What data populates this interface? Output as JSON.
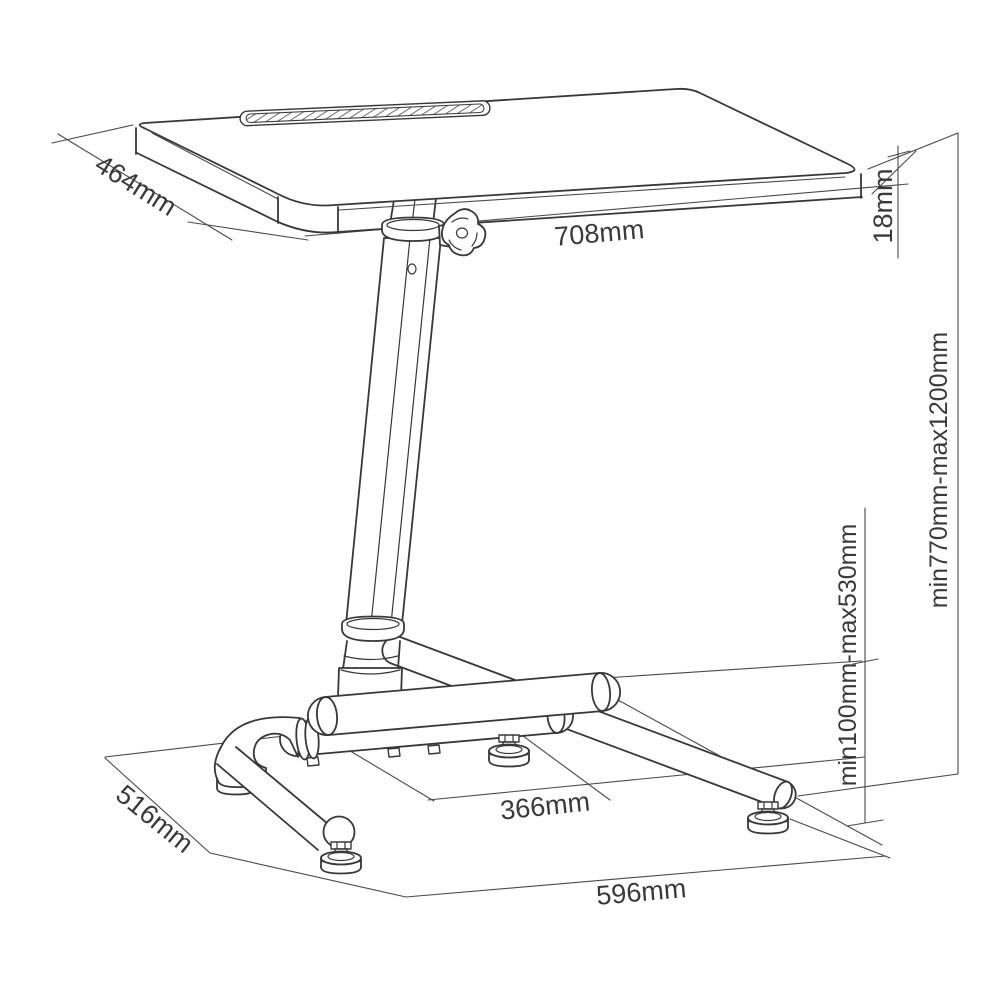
{
  "diagram": {
    "background": "#ffffff",
    "line_color": "#3d3d3d",
    "dimensions": {
      "desktop_depth": "464mm",
      "desktop_width": "708mm",
      "desktop_thickness": "18mm",
      "overall_height_range": "min770mm-max1200mm",
      "footrest_height_range": "min100mm-max530mm",
      "base_inner_span": "366mm",
      "base_depth": "516mm",
      "base_width": "596mm"
    }
  }
}
